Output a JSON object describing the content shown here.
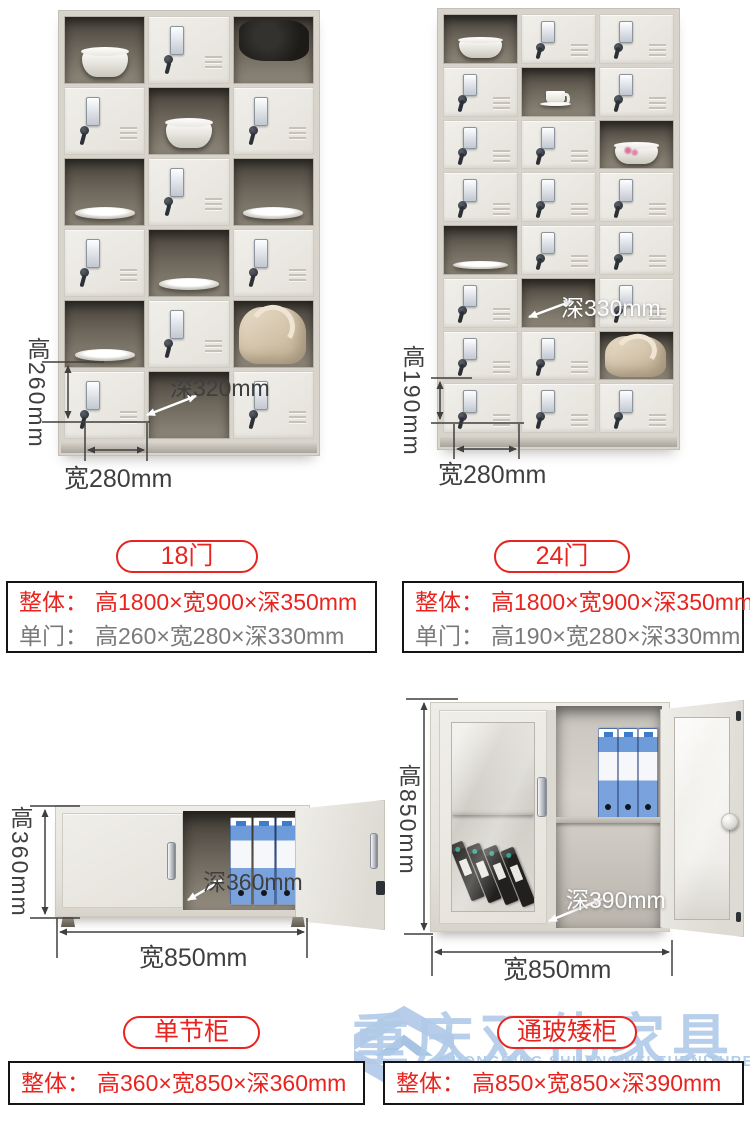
{
  "colors": {
    "red": "#e8241f",
    "gray": "#7a7a7a",
    "dim": "#3f3f3f",
    "watermark": "#b7cde9"
  },
  "products": [
    {
      "key": "locker-18",
      "title": "18门",
      "dims": {
        "height": "高260mm",
        "width": "宽280mm",
        "depth": "深320mm"
      },
      "specs": [
        {
          "label": "整体：",
          "value": "高1800×宽900×深350mm",
          "tone": "red"
        },
        {
          "label": "单门：",
          "value": "高260×宽280×深330mm",
          "tone": "gray"
        }
      ],
      "grid": {
        "rows": 6,
        "cols": 3,
        "open": {
          "0-0": "bowl",
          "0-2": "cloth",
          "1-1": "bowl",
          "2-0": "plate",
          "2-2": "plate",
          "3-1": "plate",
          "4-0": "plate",
          "4-2": "bag",
          "5-1": "empty"
        }
      }
    },
    {
      "key": "locker-24",
      "title": "24门",
      "dims": {
        "height": "高190mm",
        "width": "宽280mm",
        "depth": "深330mm"
      },
      "specs": [
        {
          "label": "整体：",
          "value": "高1800×宽900×深350mm",
          "tone": "red"
        },
        {
          "label": "单门：",
          "value": "高190×宽280×深330mm",
          "tone": "gray"
        }
      ],
      "grid": {
        "rows": 8,
        "cols": 3,
        "open": {
          "0-0": "bowl",
          "1-1": "cup",
          "2-2": "bowl-flower",
          "4-0": "plate",
          "5-1": "empty",
          "6-2": "bag"
        }
      }
    },
    {
      "key": "cabinet-single",
      "title": "单节柜",
      "dims": {
        "height": "高360mm",
        "width": "宽850mm",
        "depth": "深360mm"
      },
      "specs": [
        {
          "label": "整体：",
          "value": "高360×宽850×深360mm",
          "tone": "red"
        }
      ]
    },
    {
      "key": "cabinet-glass",
      "title": "通玻矮柜",
      "dims": {
        "height": "高850mm",
        "width": "宽850mm",
        "depth": "深390mm"
      },
      "specs": [
        {
          "label": "整体：",
          "value": "高850×宽850×深390mm",
          "tone": "red"
        }
      ]
    }
  ],
  "watermark": {
    "cn": "重庆双伟家具",
    "en": "CHONGQING SHUANGWEI FURNITURE"
  }
}
